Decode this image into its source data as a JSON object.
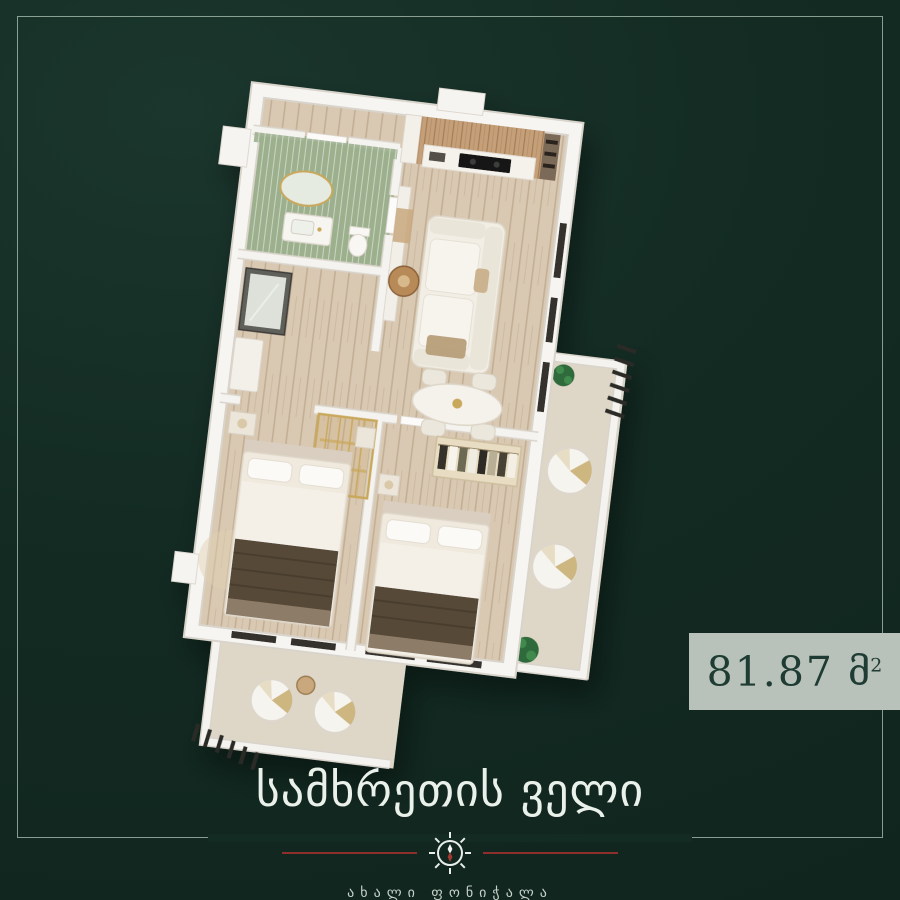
{
  "poster": {
    "area_badge": {
      "value": "81.87",
      "unit": "მ",
      "unit_exponent": "2"
    },
    "brand": {
      "title": "სამხრეთის ველი",
      "subtitle": "ახალი ფონიჭალა"
    }
  },
  "floor_plan": {
    "type": "3d-isometric-apartment-render",
    "total_area_sqm": 81.87,
    "rooms": [
      "bathroom",
      "hallway",
      "kitchen",
      "living-room",
      "dining-area",
      "bedroom-1",
      "bedroom-2",
      "balcony-right",
      "balcony-bottom"
    ]
  },
  "theme": {
    "bg": "#132b23",
    "frame-line": "#a9bfb2",
    "accent-red": "#8e2f2b",
    "title-color": "#eaf0ea",
    "subtitle-color": "#c6d2c9",
    "badge-bg": "#b8c2ba",
    "badge-text": "#1e3c33",
    "wall-white": "#f6f4f0",
    "wood-floor": "#d9c8b2",
    "tile-green": "#9cb08e",
    "gold": "#c9a85c",
    "railing-dark": "#2b2a26"
  }
}
